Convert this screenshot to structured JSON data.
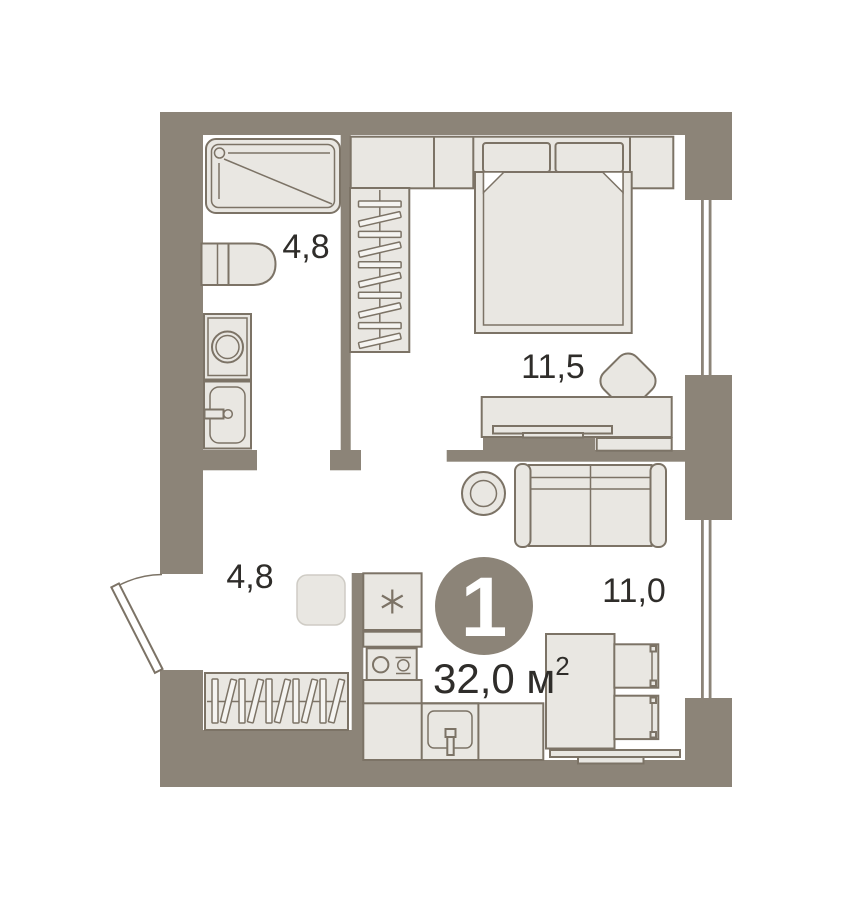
{
  "plan": {
    "unit": {
      "rooms_count_badge": "1",
      "total_area": "32,0 м",
      "total_area_superscript": "2"
    },
    "rooms": {
      "bathroom": {
        "name": "bathroom",
        "area": "4,8"
      },
      "hallway": {
        "name": "hallway",
        "area": "4,8"
      },
      "bedroom": {
        "name": "bedroom",
        "area": "11,5"
      },
      "living_kitchen": {
        "name": "living room",
        "area": "11,0"
      }
    },
    "colors": {
      "wall": "#8c8478",
      "furn-fill": "#e9e7e2",
      "furn-stroke": "#7c7366",
      "slat-fill": "#f5f4f1",
      "ink": "#2f2d2a",
      "badge": "#8c8478",
      "badge-text": "#ffffff"
    },
    "fixtures": [
      "shower-tray",
      "toilet",
      "washing-machine",
      "bathroom-sink",
      "hanging-closet",
      "wardrobe-cabinets",
      "double-bed",
      "desk",
      "desk-chair",
      "tv-shelf",
      "sofa",
      "rug",
      "fridge",
      "cooktop",
      "kitchen-counter",
      "kitchen-sink",
      "dining-table",
      "dining-chair",
      "bench",
      "stool",
      "hallway-wardrobe",
      "entrance-door",
      "window"
    ]
  }
}
